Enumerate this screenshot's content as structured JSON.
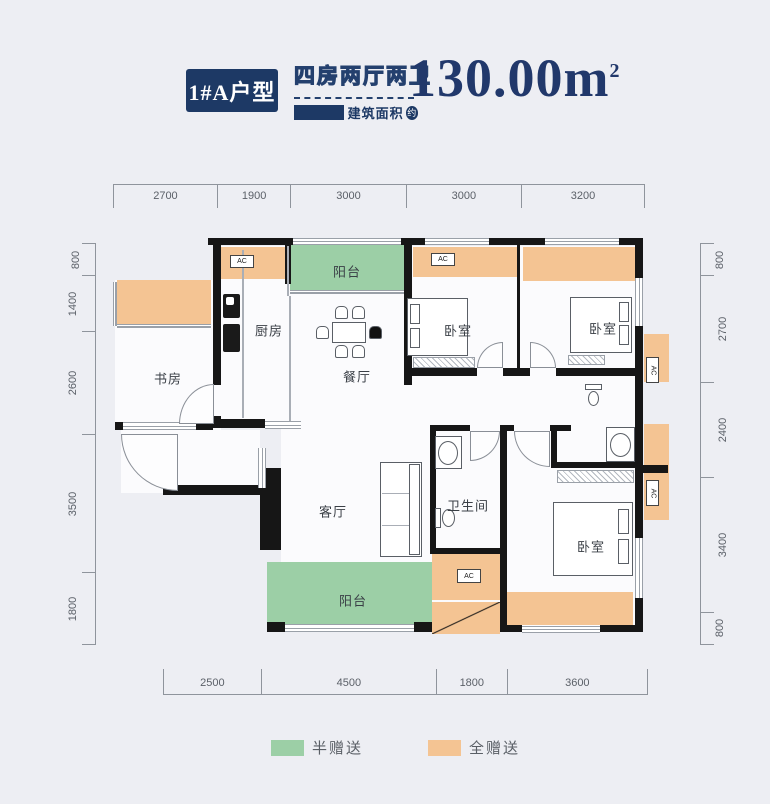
{
  "header": {
    "unit_badge": "1#A户型",
    "layout_type": "四房两厅两卫",
    "area_label": "建筑面积",
    "approx_badge": "约",
    "area_value": "130.00m",
    "area_superscript": "2"
  },
  "dimensions": {
    "top": [
      "2700",
      "1900",
      "3000",
      "3000",
      "3200"
    ],
    "left": [
      "800",
      "1400",
      "2600",
      "3500",
      "1800"
    ],
    "right": [
      "800",
      "2700",
      "2400",
      "3400",
      "800"
    ],
    "bottom": [
      "2500",
      "4500",
      "1800",
      "3600"
    ]
  },
  "plan": {
    "ac_label": "AC",
    "rooms": [
      {
        "name": "study",
        "label": "书房",
        "x": 55,
        "y": 140
      },
      {
        "name": "kitchen",
        "label": "厨房",
        "x": 156,
        "y": 92
      },
      {
        "name": "balcony-top",
        "label": "阳台",
        "x": 234,
        "y": 33
      },
      {
        "name": "dining-room",
        "label": "餐厅",
        "x": 244,
        "y": 138
      },
      {
        "name": "bedroom-1",
        "label": "卧室",
        "x": 345,
        "y": 92
      },
      {
        "name": "bedroom-2",
        "label": "卧室",
        "x": 490,
        "y": 90
      },
      {
        "name": "living-room",
        "label": "客厅",
        "x": 220,
        "y": 273
      },
      {
        "name": "bathroom",
        "label": "卫生间",
        "x": 355,
        "y": 267
      },
      {
        "name": "bedroom-3",
        "label": "卧室",
        "x": 478,
        "y": 308
      },
      {
        "name": "balcony-bottom",
        "label": "阳台",
        "x": 240,
        "y": 362
      }
    ]
  },
  "legend": [
    {
      "label": "半赠送",
      "color": "#9ccfa6"
    },
    {
      "label": "全赠送",
      "color": "#f4c493"
    }
  ],
  "colors": {
    "accent_navy": "#1d3965",
    "half_gift_green": "#9ccfa6",
    "full_gift_orange": "#f4c493",
    "wall_black": "#161616",
    "page_background": "#edeef3",
    "dimension_text": "#5b6068"
  }
}
